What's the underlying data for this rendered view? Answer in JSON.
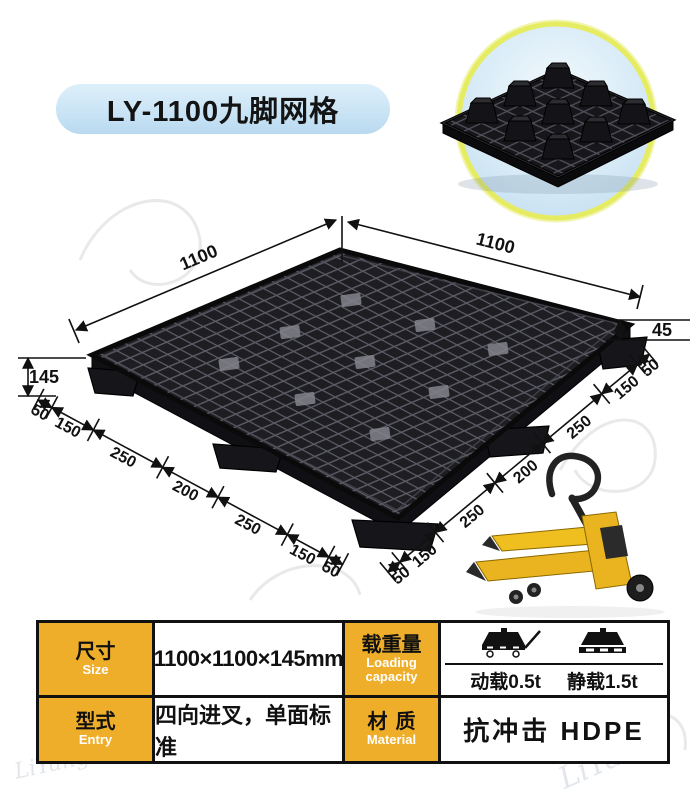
{
  "badge": {
    "text": "LY-1100九脚网格"
  },
  "diagram": {
    "top_left_edge": "1100",
    "top_right_edge": "1100",
    "overall_height": "145",
    "deck_thickness": "45",
    "bottom_left_chain": [
      "50",
      "150",
      "250",
      "200",
      "250",
      "150",
      "50"
    ],
    "bottom_right_chain": [
      "50",
      "150",
      "250",
      "200",
      "250",
      "150",
      "50"
    ]
  },
  "spec_table": {
    "size": {
      "zh": "尺寸",
      "en": "Size",
      "value": "1100×1100×145mm"
    },
    "loading": {
      "zh": "载重量",
      "en": "Loading capacity",
      "dynamic": "动载0.5t",
      "static": "静载1.5t"
    },
    "entry": {
      "zh": "型式",
      "en": "Entry",
      "value": "四向进叉，单面标准"
    },
    "material": {
      "zh": "材质",
      "en": "Material",
      "value": "抗冲击 HDPE"
    }
  },
  "watermark": {
    "brand": "LiYang"
  },
  "colors": {
    "badge_bg": "#c9e3f6",
    "label_cell_bg": "#efae29",
    "photo_ring": "#e6ec62",
    "pallet_black": "#1a1a1e",
    "jack_yellow": "#e9b41f"
  }
}
